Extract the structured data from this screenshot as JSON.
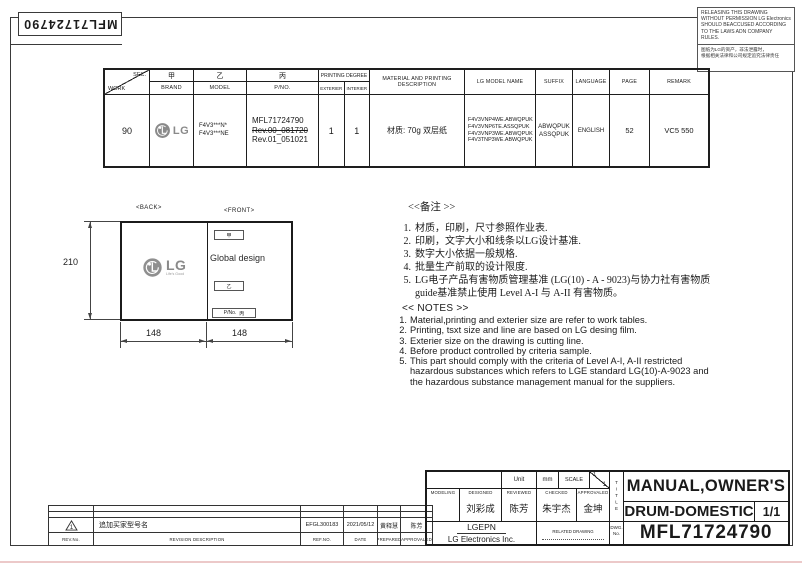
{
  "sheet": {
    "top_left_part_no": "MFL71724790"
  },
  "warning_box": {
    "en": "RELEASING THIS DRAWING\nWITHOUT PERMISSION LG Electronics\nSHOULD BEACCUSED ACCORDING\nTO THE LAWS ADN COMPANY\nRULES.",
    "cn": "图纸为LG的资产，非法泄露时，\n根据相关法律和公司规定追究法律责任"
  },
  "spec_table": {
    "headers": {
      "sec": "SEC.",
      "work": "WORK",
      "jia": "甲",
      "brand": "BRAND",
      "yi": "乙",
      "model": "MODEL",
      "bing": "丙",
      "pno": "P/NO.",
      "printing_degree": "PRINTING DEGREE",
      "exterier": "EXTERIER",
      "interier": "INTERIER",
      "material": "MATERIAL AND PRINTING DESCRIPTION",
      "lg_model_name": "LG MODEL NAME",
      "suffix": "SUFFIX",
      "language": "LANGUAGE",
      "page": "PAGE",
      "remark": "REMARK"
    },
    "row": {
      "work": "90",
      "brand": "LG",
      "model": "F4V3***N*\nF4V3***NE",
      "pno_line1": "MFL71724790",
      "pno_rev0": "Rev.00_081720",
      "pno_rev1": "Rev.01_051021",
      "exterier": "1",
      "interier": "1",
      "material": "材质: 70g 双层纸",
      "lg_models": "F4V3VNP4WE.ABWQPUK\nF4V3VNP6TE.ASSQPUK\nF4V3VNP3WE.ABWQPUK\nF4V3TNP3WE.ABWQPUK",
      "suffix": "ABWQPUK\nASSQPUK",
      "language": "ENGLISH",
      "page": "52",
      "remark": "VC5 550"
    }
  },
  "drawing": {
    "back_label": "<BACK>",
    "front_label": "<FRONT>",
    "logo_text": "LG",
    "logo_tagline": "Life's Good",
    "jia": "甲",
    "global_design": "Global design",
    "yi": "乙",
    "pno_label": "P/No.",
    "bing": "丙",
    "height_dim": "210",
    "width_dim_left": "148",
    "width_dim_right": "148"
  },
  "notes": {
    "cn_title": "<<备注 >>",
    "cn_items": [
      {
        "n": "1.",
        "t": "材质，印刷，尺寸参照作业表."
      },
      {
        "n": "2.",
        "t": "印刷，文字大小和线条以LG设计基准."
      },
      {
        "n": "3.",
        "t": "数字大小依据一般规格."
      },
      {
        "n": "4.",
        "t": "批量生产前取的设计限度."
      },
      {
        "n": "5.",
        "t": "LG电子产品有害物质管理基准 (LG(10) - A - 9023)与协力社有害物质\nguide基准禁止使用 Level A-I 与 A-II 有害物质。"
      }
    ],
    "en_title": "<< NOTES >>",
    "en_items": [
      {
        "n": "1.",
        "t": "Material,printing and exterier size are refer to work tables."
      },
      {
        "n": "2.",
        "t": "Printing, tsxt  size and line are based on LG desing film."
      },
      {
        "n": "3.",
        "t": "Exterier size on the drawing is cutting line."
      },
      {
        "n": "4.",
        "t": "Before product controlled by criteria sample."
      },
      {
        "n": "5.",
        "t": "This part should comply with the criteria of Level A-I, A-II restricted\nhazardous substances which refers to LGE standard LG(10)-A-9023 and\nthe hazardous substance management manual for the suppliers."
      }
    ]
  },
  "revision_table": {
    "headers": {
      "rev_no": "REV.No.",
      "description": "REVISION DESCRIPTION",
      "ref_no": "REF.NO.",
      "date": "DATE",
      "prepared": "PREPARED",
      "approvaled": "APPROVALED"
    },
    "entry": {
      "rev_no": "1",
      "description": "追加买家型号名",
      "ref_no": "EFGL300183",
      "date": "2021/05/12",
      "prepared": "黄释慧",
      "approvaled": "陈芳"
    }
  },
  "title_block": {
    "unit_label": "Unit",
    "unit_value": "mm",
    "scale_label": "SCALE",
    "scale_num": "1",
    "scale_den": "1",
    "modeling": "MODELING",
    "designed": "DESIGNED",
    "reviewed": "REVIEWED",
    "checked": "CHECKED",
    "approvaled": "APPROVALED",
    "designed_name": "刘彩成",
    "reviewed_name": "陈芳",
    "checked_name": "朱宇杰",
    "approvaled_name": "金坤",
    "company_short": "LGEPN",
    "company_full": "LG Electronics Inc.",
    "related_drawing": "RELATED DRAWING",
    "title_label": "TITLE",
    "title_line1": "MANUAL,OWNER'S",
    "title_line2": "DRUM-DOMESTIC",
    "sheet_no": "1/1",
    "dwg_label": "DWG.\nNo.",
    "dwg_no": "MFL71724790"
  },
  "colors": {
    "ink": "#1a1a1a",
    "logo_gray": "#8a8a8a",
    "bottom_strip": "#ecc9c9"
  }
}
